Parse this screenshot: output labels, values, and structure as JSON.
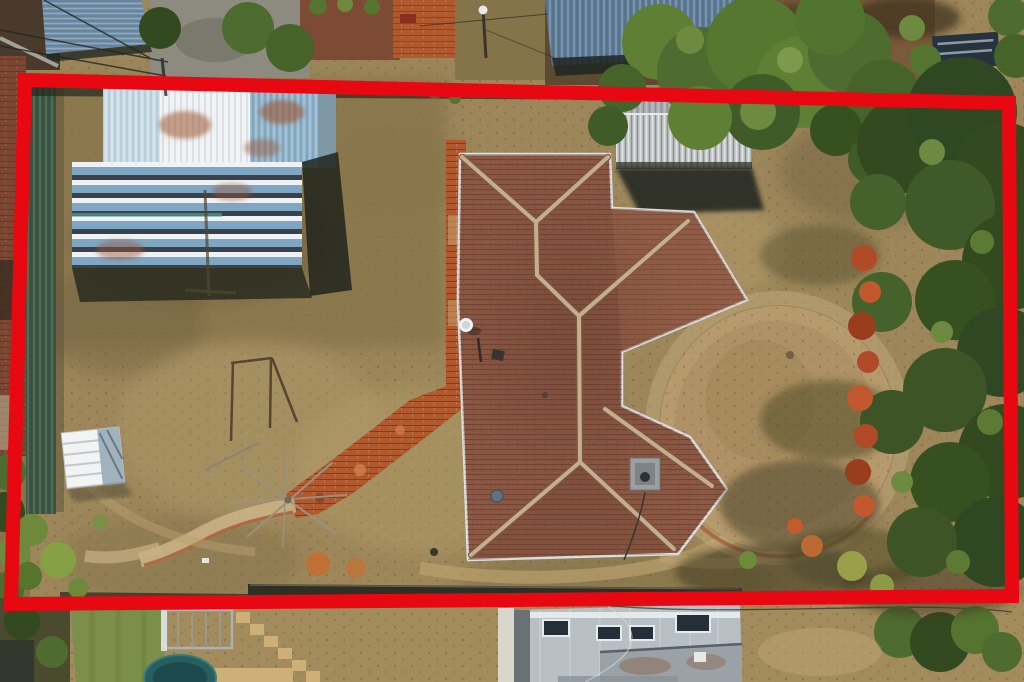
{
  "scene": {
    "type": "aerial-drone-photo",
    "description": "Top-down aerial photograph of a suburban property with dry brown lawn, a terracotta hip-roof house, sheds and trees, outlined by a thick red property-boundary overlay",
    "width_px": 1024,
    "height_px": 682
  },
  "annotation": {
    "name": "property-boundary",
    "shape": "quadrilateral",
    "stroke_px": 14,
    "corners": [
      [
        25,
        80
      ],
      [
        1009,
        103
      ],
      [
        1012,
        596
      ],
      [
        11,
        604
      ]
    ]
  },
  "palette": {
    "boundary-red": "#e70812",
    "grass-base": "#9c865a",
    "grass-light": "#b5a06c",
    "grass-olive": "#857349",
    "grass-dark": "#6f603e",
    "dirt-tan": "#c2a878",
    "dirt-light": "#d6bf8e",
    "shadow-dark": "#2e2c1e",
    "tree-dark": "#33491f",
    "tree-green": "#4e6b30",
    "tree-light": "#6e8a41",
    "tree-bright": "#5f8034",
    "shrub-red": "#b14a26",
    "shrub-orange": "#c07034",
    "bush-yellow": "#9aa04a",
    "roof-tile": "#8f5a45",
    "roof-tile-dark": "#6f4434",
    "roof-tile-light": "#a06b50",
    "ridge-tan": "#c5ad8e",
    "gutter-grey": "#dde1e4",
    "shed-white": "#eef2f4",
    "shed-pale-blue": "#c9dde8",
    "shed-blue": "#8fb4cc",
    "slat-blue": "#7fa6c2",
    "rust": "#9c5530",
    "grey-shed": "#c4c8ca",
    "grey-shed-dark": "#989c9e",
    "steel-blue-roof": "#5e7b97",
    "steel-blue-light": "#7693ad",
    "green-fence": "#3b5743",
    "brick-path": "#b0592f",
    "brick-light": "#cf7f4e",
    "brick-wall": "#7b4733",
    "concrete": "#8d8a80",
    "road-dirt": "#7a5a3a",
    "car-glass": "#26323e",
    "modern-roof": "#b7bfc5",
    "modern-roof-dark": "#9aa1a7",
    "modern-wall": "#6a7175",
    "skylight": "#252f3a",
    "trampoline": "#275f60",
    "lawn-green": "#7b8f4a",
    "stone-tan": "#cdb078",
    "white": "#f2f4f4",
    "pole-dark": "#2c2c24"
  },
  "objects": [
    {
      "name": "property-boundary",
      "desc": "thick red rectangle overlay marking lot boundary"
    },
    {
      "name": "main-house-roof",
      "desc": "terracotta tiled hip roof with two diagonal wings, light grey gutters"
    },
    {
      "name": "satellite-dish",
      "desc": "white dish on west roof edge"
    },
    {
      "name": "evaporative-cooler",
      "desc": "grey cooler box on south roof"
    },
    {
      "name": "corrugated-shed",
      "desc": "large weathered white/blue iron shed with rust, top-left"
    },
    {
      "name": "grey-garden-shed",
      "desc": "grey corrugated gable shed, top-centre"
    },
    {
      "name": "green-colorbond-fence",
      "desc": "dark green fence along west boundary"
    },
    {
      "name": "white-garden-structure",
      "desc": "small white slatted structure mid-left"
    },
    {
      "name": "timber-frame",
      "desc": "bare timber post frame in yard"
    },
    {
      "name": "fallen-clothesline",
      "desc": "collapsed rotary clothesline arms on lawn"
    },
    {
      "name": "brick-path",
      "desc": "orange-red brick path running diagonally from house to south-west"
    },
    {
      "name": "oval-lawn-patch",
      "desc": "oval dead-lawn patch with brick edging east of house"
    },
    {
      "name": "red-shrub-row",
      "desc": "row of red/crimson shrubs along east side"
    },
    {
      "name": "tree-canopy-east",
      "desc": "dense dark green trees along right boundary"
    },
    {
      "name": "tree-canopy-north",
      "desc": "large green tree over north boundary"
    },
    {
      "name": "neighbour-steel-building",
      "desc": "steel blue roofed building beyond north boundary"
    },
    {
      "name": "neighbour-modern-house",
      "desc": "grey flat-roof modern house with skylights, bottom"
    },
    {
      "name": "trampoline",
      "desc": "teal trampoline in bottom neighbour yard"
    },
    {
      "name": "garden-gate",
      "desc": "metal gate in bottom neighbour yard"
    },
    {
      "name": "stepping-stones",
      "desc": "diagonal sandstone stepping stones, bottom yard"
    },
    {
      "name": "power-pole",
      "desc": "power pole and overhead wires, top of frame"
    },
    {
      "name": "dry-lawn",
      "desc": "patchy drought-browned lawn across the lot"
    }
  ]
}
